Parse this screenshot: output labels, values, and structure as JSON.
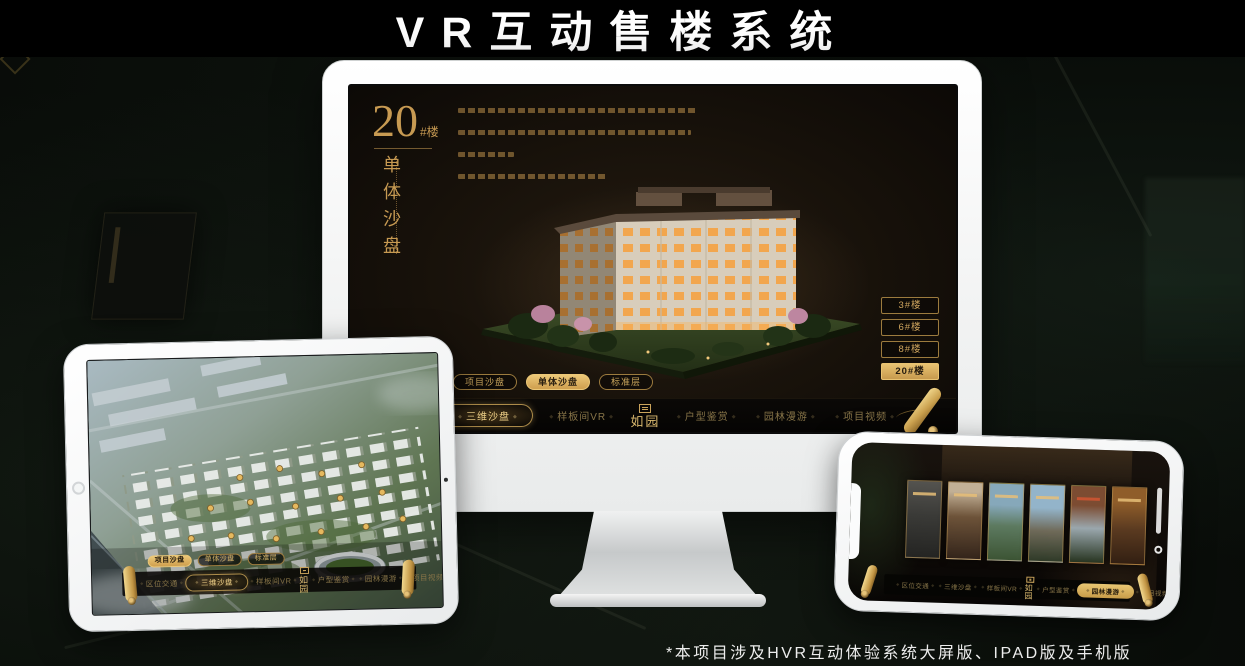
{
  "title": "VR互动售楼系统",
  "footnote": "*本项目涉及HVR互动体验系统大屏版、IPAD版及手机版",
  "brand": {
    "logo": "如园"
  },
  "nav_items": [
    "区位交通",
    "三维沙盘",
    "样板间VR",
    "户型鉴赏",
    "园林漫游",
    "项目视频"
  ],
  "view_tabs": [
    "项目沙盘",
    "单体沙盘",
    "标准层"
  ],
  "monitor": {
    "block_no": "20",
    "block_suffix": "#楼",
    "block_name": "单体沙盘",
    "floor_buttons": [
      "3#楼",
      "6#楼",
      "8#楼",
      "20#楼"
    ],
    "active_floor": "20#楼",
    "active_view_tab": "单体沙盘",
    "active_nav_item": "三维沙盘"
  },
  "tablet": {
    "active_view_tab": "项目沙盘",
    "active_nav_item": "三维沙盘"
  },
  "phone": {
    "active_nav_item": "园林漫游",
    "scene_card_count": "6"
  },
  "colors": {
    "gold": "#cda55c",
    "gold_bright": "#ecc878",
    "screen_background": "#17110b",
    "title_text": "#ffffff"
  }
}
